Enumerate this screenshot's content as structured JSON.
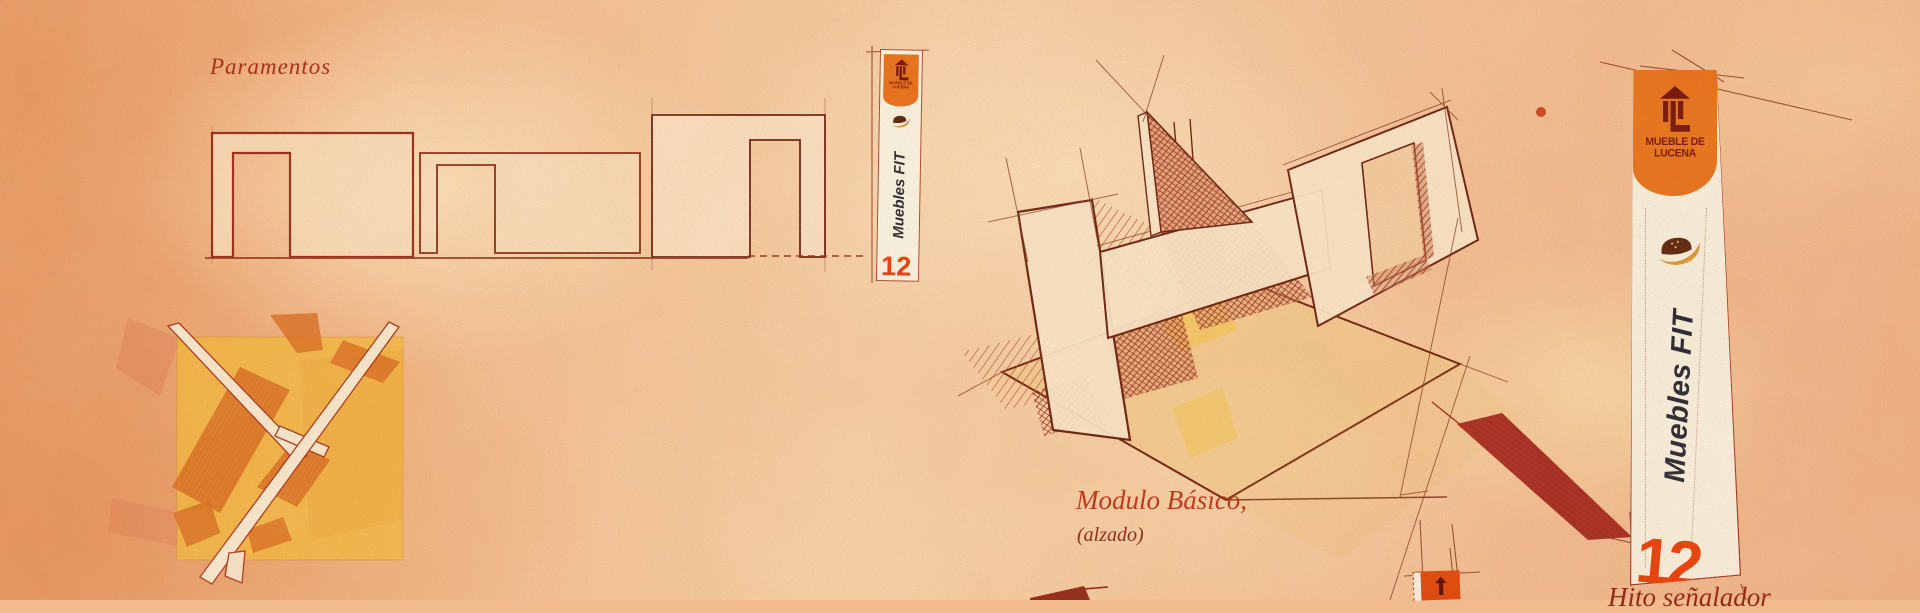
{
  "captions": {
    "paramentos": "Paramentos",
    "modulo_basico": "Modulo Básico,",
    "alzado": "(alzado)",
    "hito_senalador": "Hito señalador"
  },
  "banner_large": {
    "logo_line1": "MUEBLE DE",
    "logo_line2": "LUCENA",
    "brand": "Muebles FIT",
    "number": "12"
  },
  "banner_small": {
    "logo_line1": "MUEBLE DE",
    "logo_line2": "LUCENA",
    "brand": "Muebles FIT",
    "number": "12"
  },
  "icons": {
    "large_banner_logo": "tower-arrow-icon",
    "large_banner_brand_icon": "armchair-swoosh-icon",
    "small_banner_logo": "tower-arrow-icon",
    "small_banner_brand_icon": "armchair-swoosh-icon",
    "bottom_banner_logo": "arrow-tower-icon"
  },
  "colors": {
    "paper": "#f3c094",
    "accent_orange": "#e8721c",
    "logo_dark": "#77180e",
    "number_orange": "#e8420c",
    "ink_brown": "#6e2412",
    "caption_red": "#a92d17",
    "shadow_crimson": "#a4271c",
    "plan_yellow": "#f4b93e",
    "plan_orange": "#dc7226"
  }
}
